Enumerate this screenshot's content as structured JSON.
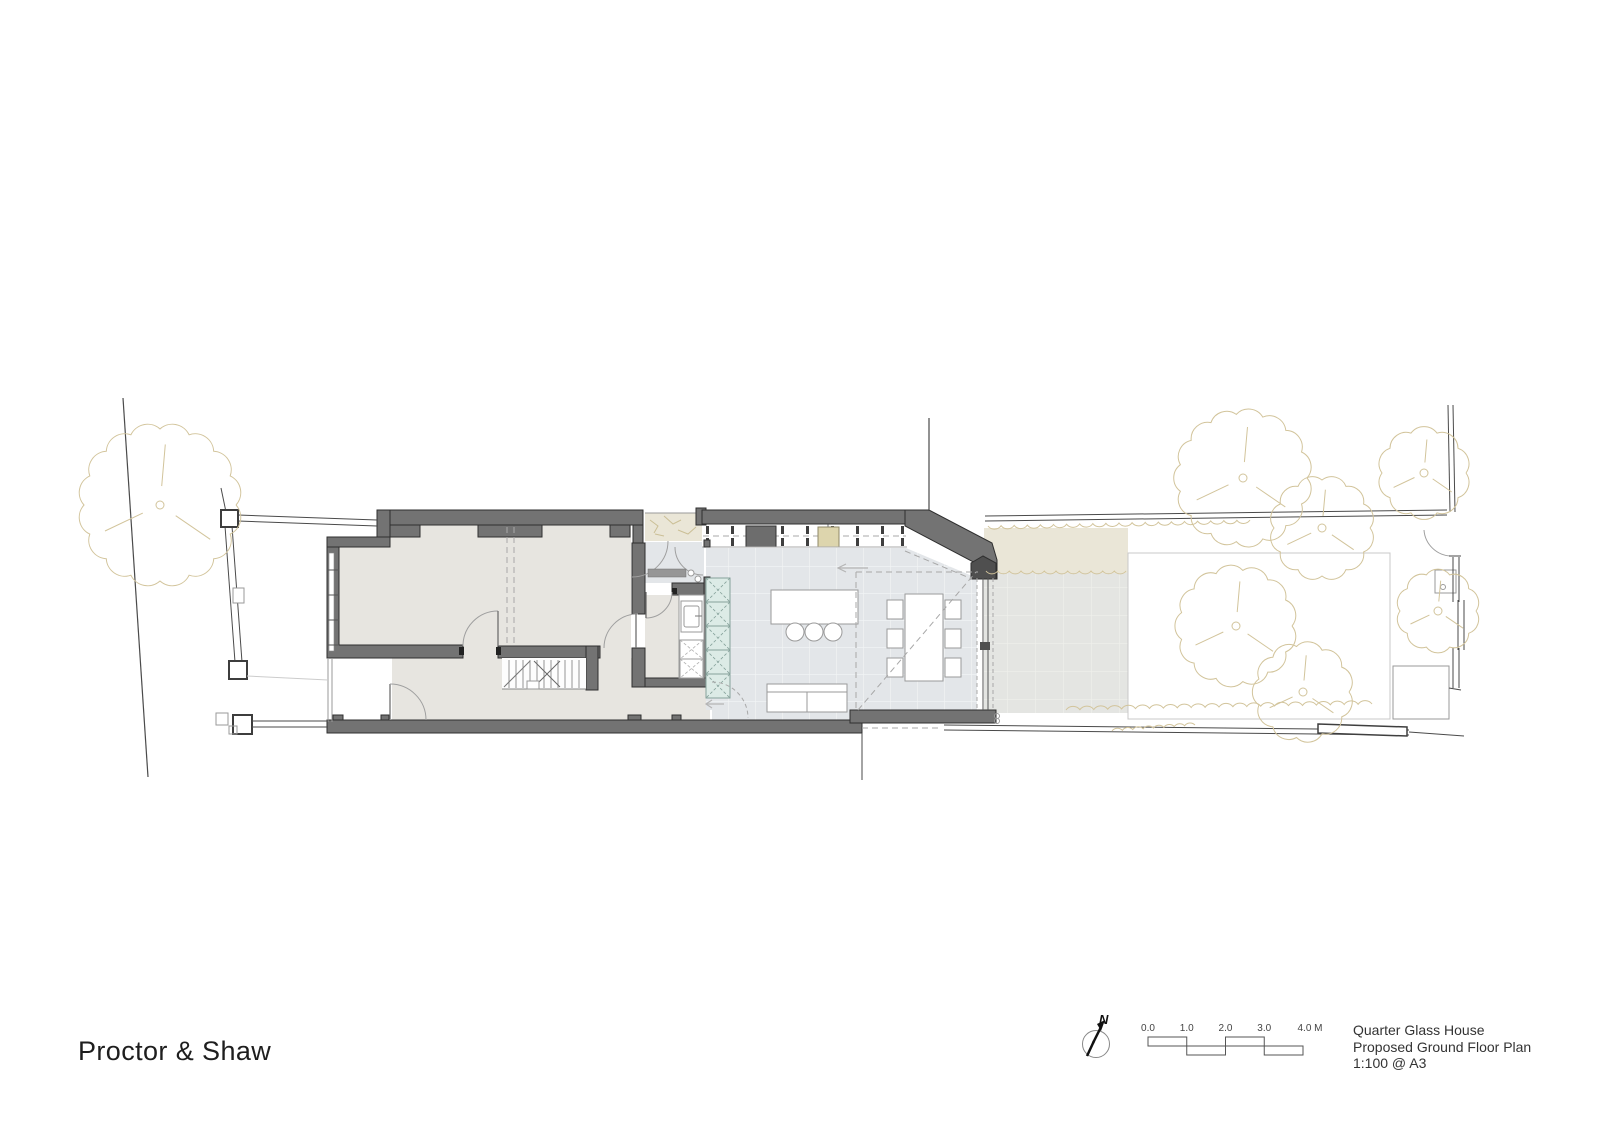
{
  "branding": {
    "studio_name": "Proctor & Shaw"
  },
  "title_block": {
    "project": "Quarter Glass House",
    "drawing_title": "Proposed Ground Floor Plan",
    "scale": "1:100 @ A3"
  },
  "north_arrow": {
    "label": "N"
  },
  "scale_bar": {
    "labels": [
      "0.0",
      "1.0",
      "2.0",
      "3.0",
      "4.0 M"
    ],
    "unit": "M"
  },
  "colors": {
    "wall": "#737373",
    "wall_dark": "#4f4f4f",
    "wall_outline": "#2f2f2f",
    "jamb": "#222222",
    "floor_warm": "#e7e5e0",
    "floor_cool": "#e3e6e9",
    "floor_grid": "#f3f5f6",
    "patio": "#e4e5e2",
    "patio_grid": "#efF0ec",
    "planting": "#eae6d7",
    "landscape_line": "#d2c49b",
    "unit_teal_fill": "#dcebe6",
    "unit_teal_line": "#86a29b",
    "fixture_line": "#9a9a9a",
    "dash_line": "#a8a8a8",
    "boundary_line": "#4a4a4a",
    "rooflight_dark": "#6d6d6d",
    "rooflight_tan": "#ddd5ad"
  }
}
